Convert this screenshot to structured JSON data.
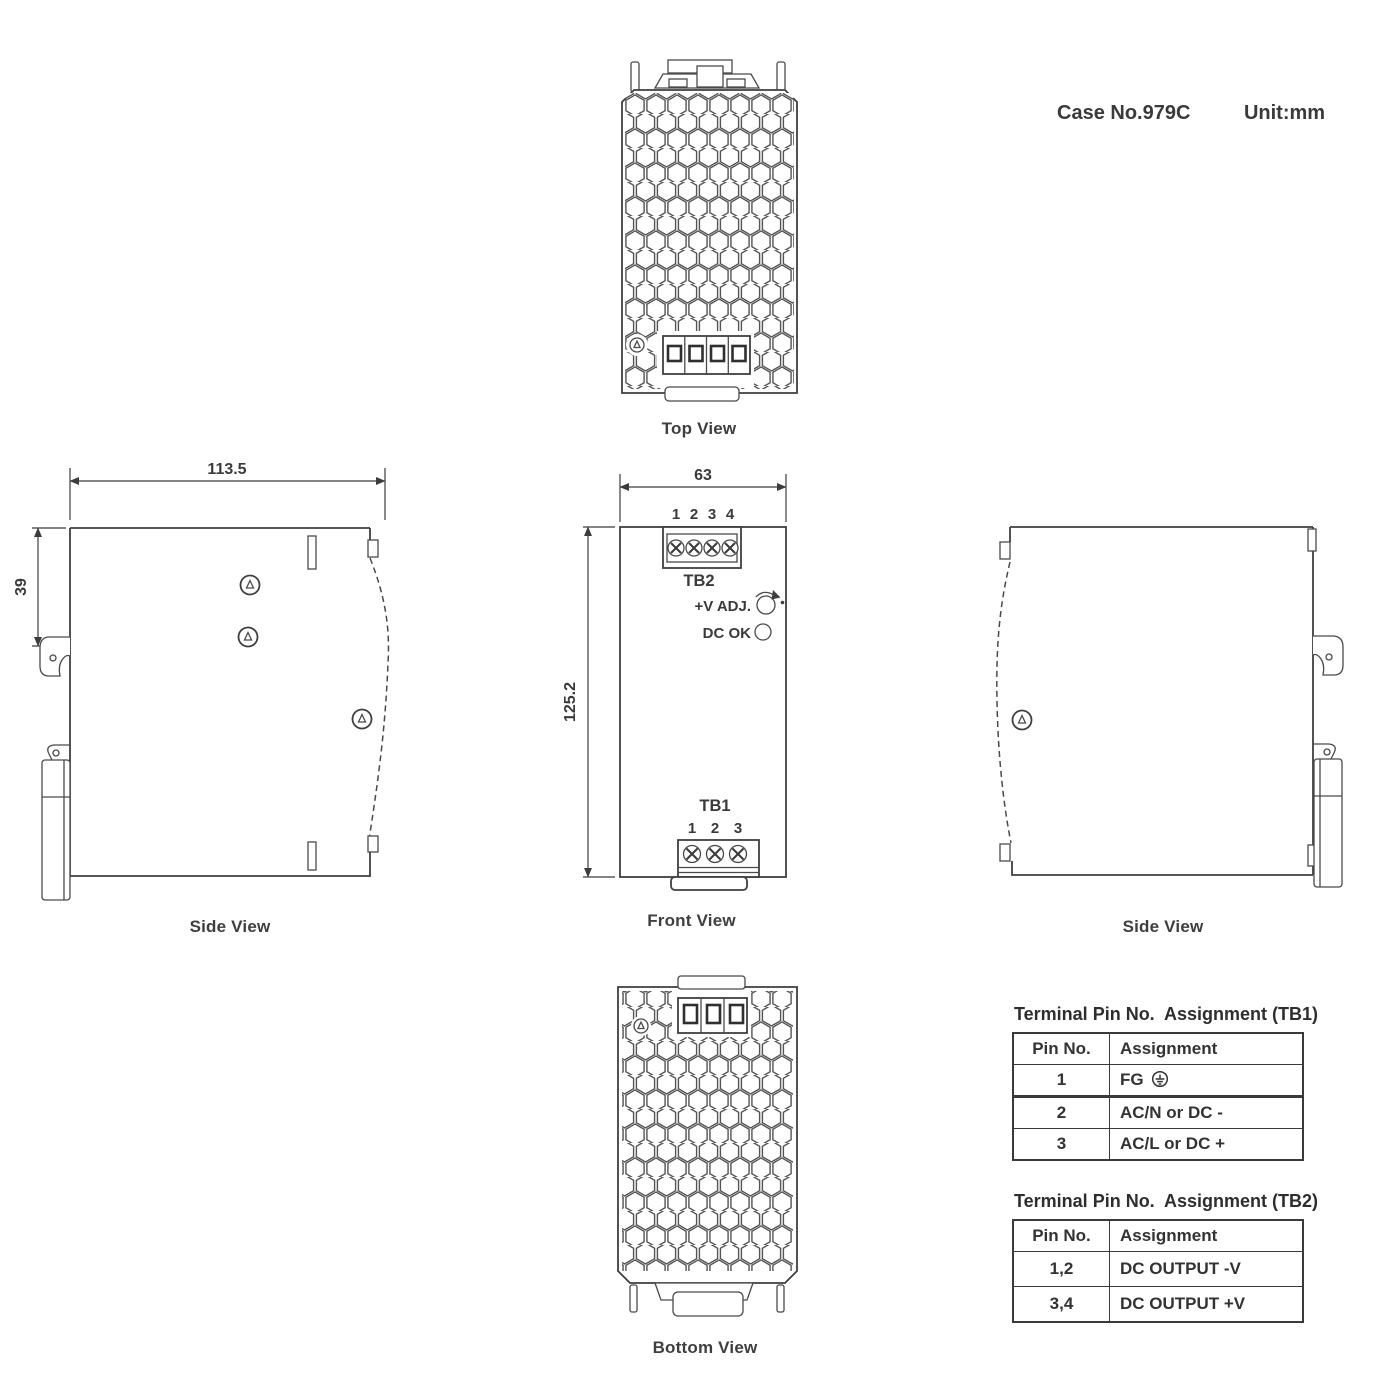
{
  "header": {
    "case_no": "Case No.979C",
    "unit": "Unit:mm"
  },
  "views": {
    "top": {
      "label": "Top View"
    },
    "side_left": {
      "label": "Side View",
      "dim_width": "113.5",
      "dim_height": "39"
    },
    "front": {
      "label": "Front View",
      "dim_width": "63",
      "dim_height": "125.2",
      "tb2": {
        "label": "TB2",
        "pins": [
          "1",
          "2",
          "3",
          "4"
        ]
      },
      "tb1": {
        "label": "TB1",
        "pins": [
          "1",
          "2",
          "3"
        ]
      },
      "vadj_label": "+V ADJ.",
      "dcok_label": "DC OK"
    },
    "side_right": {
      "label": "Side View"
    },
    "bottom": {
      "label": "Bottom View"
    }
  },
  "tables": {
    "tb1": {
      "title": "Terminal Pin No.  Assignment (TB1)",
      "headers": [
        "Pin No.",
        "Assignment"
      ],
      "rows": [
        {
          "pin": "1",
          "assignment": "FG",
          "icon": "earth-ground"
        },
        {
          "pin": "2",
          "assignment": "AC/N or DC -"
        },
        {
          "pin": "3",
          "assignment": "AC/L or DC +"
        }
      ]
    },
    "tb2": {
      "title": "Terminal Pin No.  Assignment (TB2)",
      "headers": [
        "Pin No.",
        "Assignment"
      ],
      "rows": [
        {
          "pin": "1,2",
          "assignment": "DC OUTPUT -V"
        },
        {
          "pin": "3,4",
          "assignment": "DC OUTPUT +V"
        }
      ]
    }
  }
}
